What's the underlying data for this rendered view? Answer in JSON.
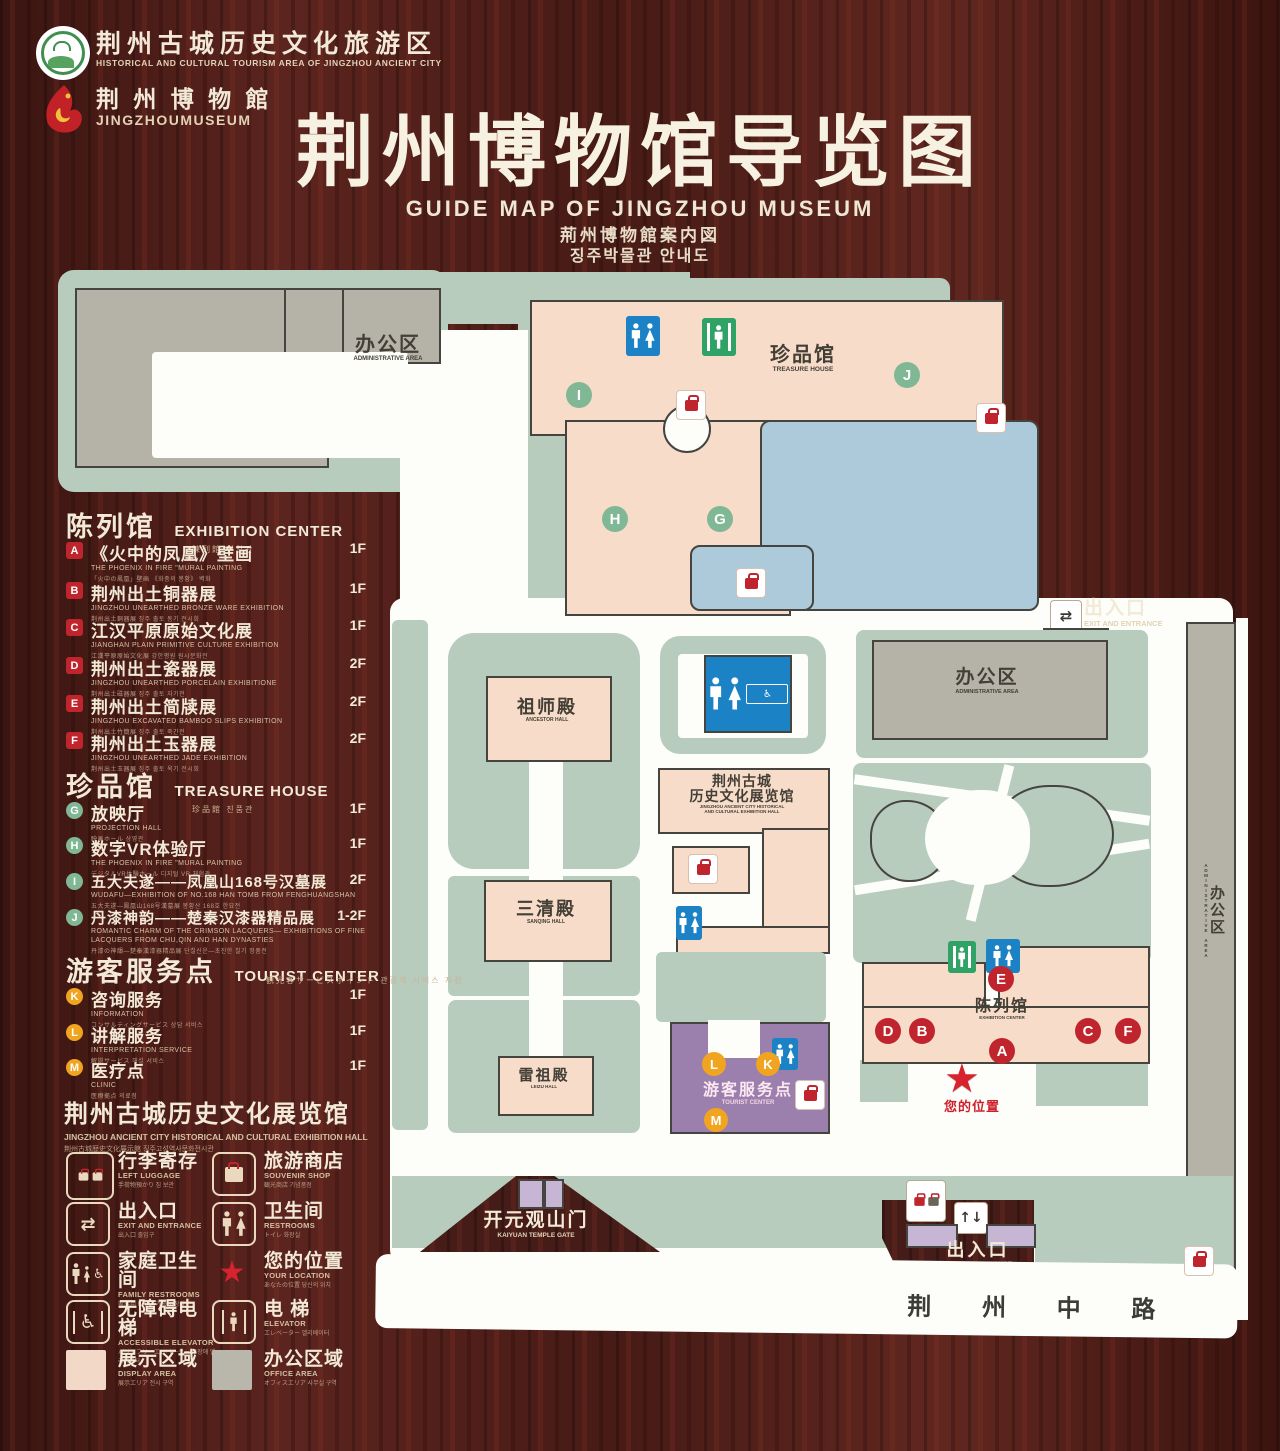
{
  "colors": {
    "wood": "#451c18",
    "map_green": "#b7ccbd",
    "building_pink": "#f7dcc9",
    "building_gray": "#b5b2a8",
    "lake_blue": "#accada",
    "tourist_purple": "#9b80ad",
    "gate_purple": "#c6b6d4",
    "restroom_blue": "#1b82c5",
    "exit_green": "#2fa265",
    "marker_red": "#c0252e",
    "marker_green": "#80b795",
    "marker_orange": "#f0a41f",
    "cream_text": "#f2e9d6",
    "location_red": "#d8232e"
  },
  "header": {
    "tourism_logo": {
      "zh": "荆州古城历史文化旅游区",
      "en": "HISTORICAL AND CULTURAL TOURISM AREA OF JINGZHOU ANCIENT CITY"
    },
    "museum_logo": {
      "zh": "荆 州 博 物 館",
      "en": "JINGZHOUMUSEUM"
    },
    "title": {
      "zh": "荆州博物馆导览图",
      "en": "GUIDE MAP OF JINGZHOU MUSEUM",
      "ja": "荊州博物館案内図",
      "ko": "징주박물관 안내도"
    }
  },
  "legend": {
    "sections": [
      {
        "zh": "陈列馆",
        "en": "EXHIBITION CENTER",
        "sub": "陳列館  진열관",
        "items": [
          {
            "key": "A",
            "zh": "《火中的凤凰》壁画",
            "en": "THE PHOENIX IN FIRE \"MURAL PAINTING",
            "sub": "「火中の鳳凰」壁画 《화중의 봉황》 벽화",
            "floor": "1F"
          },
          {
            "key": "B",
            "zh": "荆州出土铜器展",
            "en": "JINGZHOU UNEARTHED BRONZE WARE EXHIBITION",
            "sub": "荆州出土銅器展  징주 출토 동기 전시회",
            "floor": "1F"
          },
          {
            "key": "C",
            "zh": "江汉平原原始文化展",
            "en": "JIANGHAN PLAIN PRIMITIVE CULTURE EXHIBITION",
            "sub": "江漢平原原始文化展  강한평원 원시문화전",
            "floor": "1F"
          },
          {
            "key": "D",
            "zh": "荆州出土瓷器展",
            "en": "JINGZHOU UNEARTHED PORCELAIN EXHIBITIONE",
            "sub": "荆州出土磁器展  징주 출토 자기전",
            "floor": "2F"
          },
          {
            "key": "E",
            "zh": "荆州出土简牍展",
            "en": "JINGZHOU EXCAVATED BAMBOO SLIPS EXHIBITION",
            "sub": "荆州出土竹簡展  징주 출토 죽간전",
            "floor": "2F"
          },
          {
            "key": "F",
            "zh": "荆州出土玉器展",
            "en": "JINGZHOU UNEARTHED JADE EXHIBITION",
            "sub": "荆州出土玉器展  징주 출토 옥기 전시회",
            "floor": "2F"
          }
        ]
      },
      {
        "zh": "珍品馆",
        "en": "TREASURE HOUSE",
        "sub": "珍品館  진품관",
        "items": [
          {
            "key": "G",
            "zh": "放映厅",
            "en": "PROJECTION HALL",
            "sub": "映画ホール  상영관",
            "floor": "1F"
          },
          {
            "key": "H",
            "zh": "数字VR体验厅",
            "en": "THE PHOENIX IN FIRE \"MURAL PAINTING",
            "sub": "デジタルVR体験ホール  디지털 VR 체험관",
            "floor": "1F"
          },
          {
            "key": "I",
            "zh": "五大夫遂——凤凰山168号汉墓展",
            "en": "WUDAFU—EXHIBITION OF NO.168 HAN TOMB FROM FENGHUANGSHAN",
            "sub": "五大夫遂—鳳凰山168号漢墓展  봉황산 168호 한묘전",
            "floor": "2F"
          },
          {
            "key": "J",
            "zh": "丹漆神韵——楚秦汉漆器精品展",
            "en": "ROMANTIC CHARM OF THE CRIMSON LACQUERS— EXHIBITIONS OF FINE LACQUERS FROM CHU,QIN AND HAN DYNASTIES",
            "sub": "丹漆の神韻—楚秦漢漆器精品展  단칠신운—초진한 칠기 정품전",
            "floor": "1-2F"
          }
        ]
      },
      {
        "zh": "游客服务点",
        "en": "TOURIST CENTER",
        "sub": "観光客サービスポイント  관광객 서비스 지점",
        "items": [
          {
            "key": "K",
            "zh": "咨询服务",
            "en": "INFORMATION",
            "sub": "コンサルティングサービス  상담 서비스",
            "floor": "1F"
          },
          {
            "key": "L",
            "zh": "讲解服务",
            "en": "INTERPRETATION SERVICE",
            "sub": "解説サービス  해설 서비스",
            "floor": "1F"
          },
          {
            "key": "M",
            "zh": "医疗点",
            "en": "CLINIC",
            "sub": "医療拠点  의료점",
            "floor": "1F"
          }
        ]
      }
    ],
    "hall_title": {
      "zh": "荆州古城历史文化展览馆",
      "en": "JINGZHOU ANCIENT CITY HISTORICAL AND CULTURAL EXHIBITION HALL",
      "sub": "荆州古城歴史文化展示館    징주고성역사문화전시관"
    },
    "symbols": [
      {
        "zh": "行李寄存",
        "en": "LEFT LUGGAGE",
        "sub": "手荷物預かり  짐 보관"
      },
      {
        "zh": "旅游商店",
        "en": "SOUVENIR SHOP",
        "sub": "観光商店  기념품점"
      },
      {
        "zh": "出入口",
        "en": "EXIT AND ENTRANCE",
        "sub": "出入口  출입구"
      },
      {
        "zh": "卫生间",
        "en": "RESTROOMS",
        "sub": "トイレ  화장실"
      },
      {
        "zh": "家庭卫生间",
        "en": "FAMILY RESTROOMS",
        "sub": "家族用トイレ  가족 화장실"
      },
      {
        "zh": "您的位置",
        "en": "YOUR LOCATION",
        "sub": "あなたの位置  당신의 위치"
      },
      {
        "zh": "无障碍电梯",
        "en": "ACCESSIBLE ELEVATOR",
        "sub": "バリアフリーエレベーター  무장애 엘리베이터"
      },
      {
        "zh": "电  梯",
        "en": "ELEVATOR",
        "sub": "エレベーター  엘리베이터"
      }
    ],
    "areas": [
      {
        "zh": "展示区域",
        "en": "DISPLAY AREA",
        "sub": "展示エリア  전시 구역",
        "color": "#f2d8c6"
      },
      {
        "zh": "办公区域",
        "en": "OFFICE AREA",
        "sub": "オフィスエリア  사무실 구역",
        "color": "#b9b6ac"
      }
    ]
  },
  "map": {
    "labels": {
      "admin_top": {
        "zh": "办公区",
        "en": "ADMINISTRATIVE AREA"
      },
      "admin_right": {
        "zh": "办公区",
        "en": "ADMINISTRATIVE AREA"
      },
      "admin_side": {
        "zh": "办公区",
        "en": "ADMINISTRATIVE AREA"
      },
      "treasure": {
        "zh": "珍品馆",
        "en": "TREASURE HOUSE"
      },
      "ancestor": {
        "zh": "祖师殿",
        "en": "ANCESTOR HALL"
      },
      "sanqing": {
        "zh": "三清殿",
        "en": "SANQING HALL"
      },
      "leizu": {
        "zh": "雷祖殿",
        "en": "LEIZU HALL"
      },
      "exhibition_hall": {
        "zh1": "荆州古城",
        "zh2": "历史文化展览馆",
        "en1": "JINGZHOU ANCIENT CITY HISTORICAL",
        "en2": "AND CULTURAL EXHIBITION HALL"
      },
      "tourist": {
        "zh": "游客服务点",
        "en": "TOURIST CENTER"
      },
      "exhibition_center": {
        "zh": "陈列馆",
        "en": "EXHIBITION CENTER"
      },
      "your_location": {
        "zh": "您的位置"
      },
      "gate": {
        "zh": "开元观山门",
        "en": "KAIYUAN TEMPLE GATE"
      },
      "exit_right": {
        "zh": "出入口",
        "en": "EXIT AND ENTRANCE"
      },
      "exit_bottom": {
        "zh": "出入口",
        "en": "EXIT AND ENTRANCE"
      },
      "road": {
        "zh": "荆  州  中  路"
      }
    },
    "markers": {
      "treasure": [
        "I",
        "J",
        "H",
        "G"
      ],
      "exhibition": [
        "E",
        "D",
        "B",
        "A",
        "C",
        "F"
      ],
      "tourist": [
        "L",
        "K",
        "M"
      ]
    }
  }
}
